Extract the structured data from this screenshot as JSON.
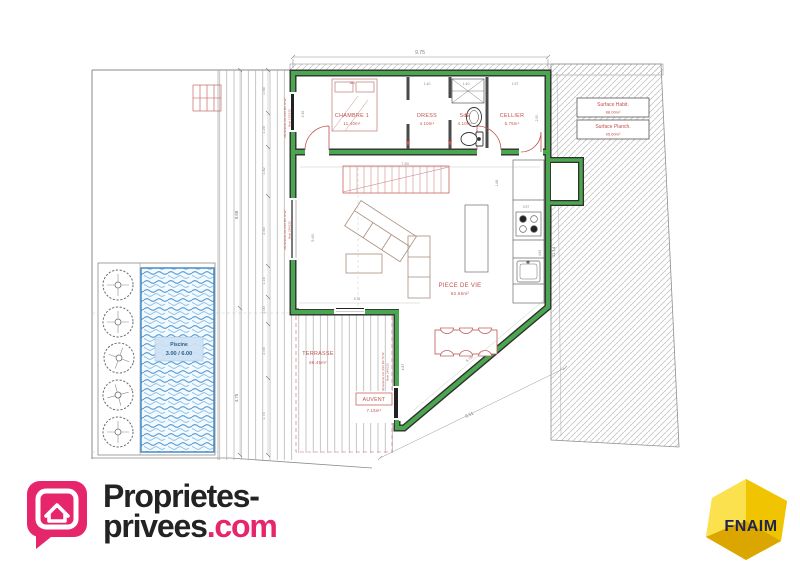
{
  "plan": {
    "rooms": {
      "chambre": {
        "name": "CHAMBRE 1",
        "area": "11.40m²"
      },
      "dress": {
        "name": "DRESS",
        "area": "4.10m²"
      },
      "sde": {
        "name": "SdE",
        "area": "4.10m²"
      },
      "cellier": {
        "name": "CELLIER",
        "area": "5.75m²"
      },
      "piece_de_vie": {
        "name": "PIECE DE VIE",
        "area": "62.65m²"
      },
      "terrasse": {
        "name": "TERRASSE",
        "area": "66.45m²"
      },
      "auvent": {
        "name": "AUVENT",
        "area": "7.15m²"
      }
    },
    "pool": {
      "name": "Piscine",
      "size": "3.00 / 6.00"
    },
    "surface_boxes": {
      "habitable": {
        "label": "Surface Habit.",
        "value": "88.00m²"
      },
      "plancher": {
        "label": "Surface Planch.",
        "value": "95.60m²"
      }
    },
    "dims": {
      "top_width": "9.75",
      "bed": "180",
      "dress_w": "1.40",
      "sde_w": "1.40",
      "cellier_w": "1.97",
      "chambre_h": "2.92",
      "cellier_h": "2.50",
      "stairs": "7.83",
      "stairs_h": "1.68",
      "kitchen_w": "0.97",
      "kitchen_h": "4.83",
      "living_h": "5.60",
      "living_w": "5.76",
      "wall_in": "5.78",
      "wall_out": "6.51",
      "door_w": "4.87",
      "parcel_right": "11.14",
      "deck_total_top": "9.68",
      "deck_total_bottom": "4.75",
      "chain": [
        "1.66",
        "1.26",
        "1.82",
        "2.60",
        "1.16",
        "1.00",
        "2.00",
        "1.70"
      ]
    },
    "annotations": {
      "menuiserie1": "Menuiserie Alu 4/16 BA 70 W",
      "baie1": "Baie 120/215",
      "menuiserie2": "Menuiserie Alu 4/16 BA 70 W",
      "baie2": "Baie 240/215",
      "menuiserie3": "Menuiserie Alu 4/16 BA 70 W",
      "baie3": "Baie 240/215"
    }
  },
  "branding": {
    "agency_line1": "Proprietes-",
    "agency_line2": "privees",
    "agency_tld": ".com",
    "fnaim": "FNAIM"
  },
  "colors": {
    "wall_green": "#4aa64f",
    "label_red": "#c0504d",
    "pool_blue": "#4a94cf",
    "brand_pink": "#e7256b",
    "fnaim_yellow": "#f4ca00"
  }
}
